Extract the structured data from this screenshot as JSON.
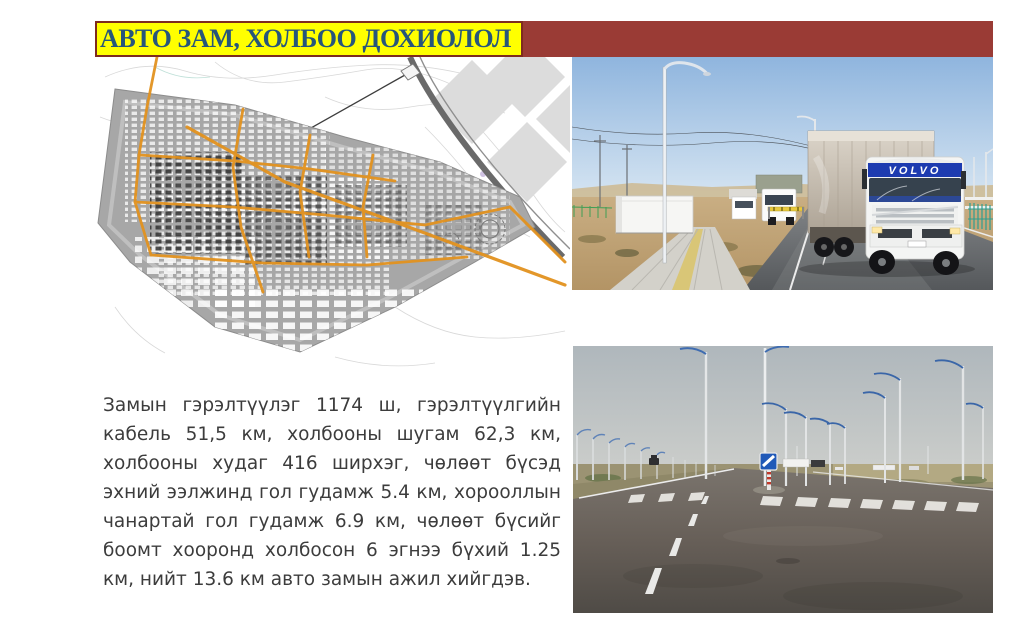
{
  "title": {
    "text": "АВТО ЗАМ, ХОЛБОО ДОХИОЛОЛ"
  },
  "body": {
    "lines": [
      "Замын гэрэлтүүлэг 1174 ш, гэрэлтүүлгийн",
      "кабель 51,5 км, холбооны шугам 62,3 км,",
      "холбооны худаг 416 ширхэг, чөлөөт бүсэд",
      "эхний ээлжинд гол гудамж 5.4 км, хорооллын",
      "чанартай гол гудамж 6.9 км, чөлөөт бүсийг",
      "боомт хооронд холбосон 6 эгнээ бүхий 1.25",
      "км,  нийт 13.6 км авто замын ажил хийгдэв."
    ]
  },
  "figures": {
    "map": {
      "label": "city-master-plan-map"
    },
    "trucks": {
      "label": "trucks-on-new-road-photo",
      "brand_text": "VOLVO"
    },
    "road": {
      "label": "empty-intersection-photo"
    }
  },
  "colors": {
    "title_bar": "#9A3B35",
    "title_highlight": "#FFFF00",
    "title_border": "#7E2B1E",
    "title_text": "#27567B",
    "body_text": "#3C3C3C",
    "map_road_orange": "#E2921F",
    "streetlight_arm_blue": "#3A66A8"
  }
}
